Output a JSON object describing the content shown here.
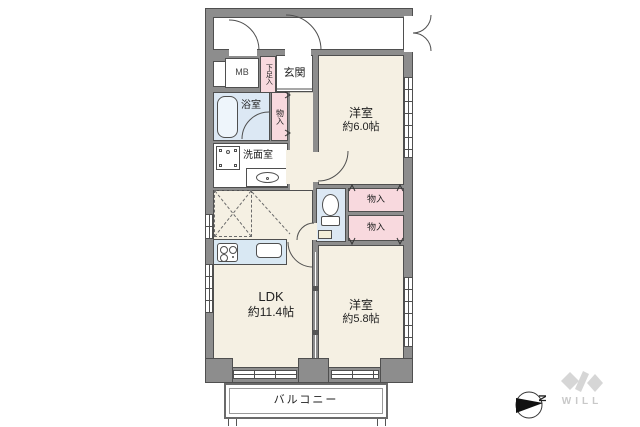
{
  "colors": {
    "wall": "#8d8d8d",
    "outline": "#4f4f4f",
    "floor": "#f5f0e3",
    "wet_area": "#dce8f4",
    "closet": "#f8d9de",
    "kitchen_counter": "#d9e8f3",
    "logo_gray": "#cccccc"
  },
  "rooms": {
    "entrance": {
      "label": "玄関"
    },
    "meter_box": {
      "label": "MB"
    },
    "shoe_cupboard": {
      "label": "下足入"
    },
    "bathroom": {
      "label": "浴室"
    },
    "hall_closet": {
      "label": "物入"
    },
    "washroom": {
      "label": "洗面室"
    },
    "bedroom1": {
      "label": "洋室",
      "size": "約6.0帖"
    },
    "storage1": {
      "label": "物入"
    },
    "storage2": {
      "label": "物入"
    },
    "bedroom2": {
      "label": "洋室",
      "size": "約5.8帖"
    },
    "ldk": {
      "label": "LDK",
      "size": "約11.4帖"
    },
    "balcony": {
      "label": "バルコニー"
    }
  },
  "compass": {
    "direction_letter": "N"
  },
  "logo": {
    "text": "WILL"
  }
}
